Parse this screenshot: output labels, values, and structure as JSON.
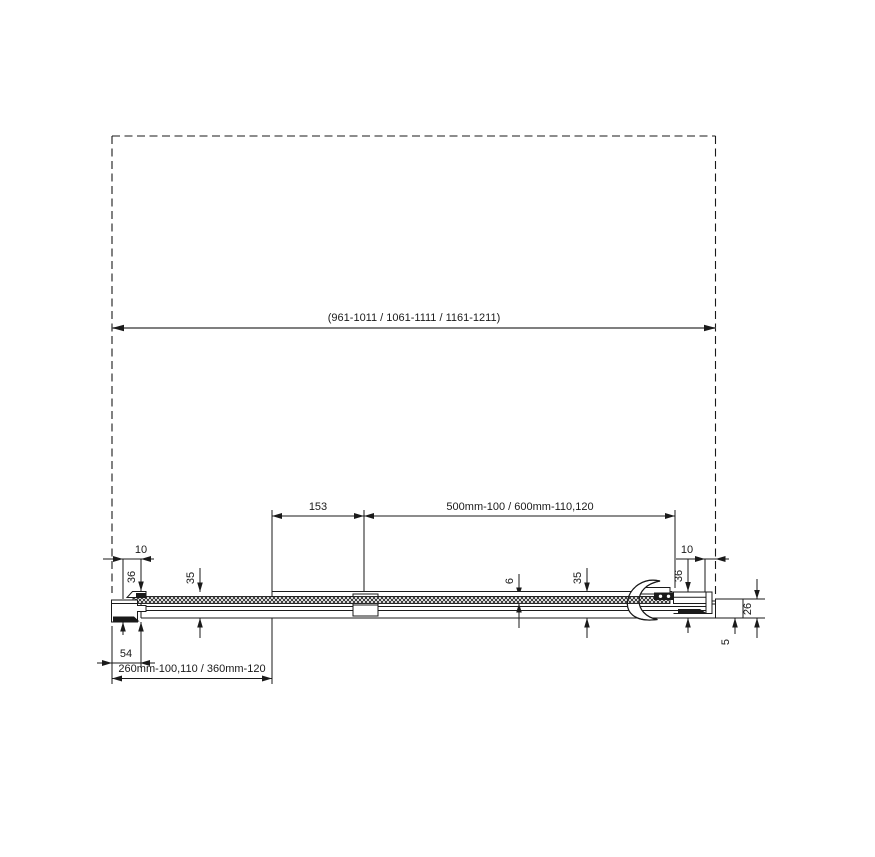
{
  "drawing": {
    "background_color": "#ffffff",
    "line_color": "#1a1a1a",
    "dimensions": {
      "overall_width_range": "(961-1011 / 1061-1111 / 1161-1211)",
      "top_rail_inset": "153",
      "door_leaf_width": "500mm-100 / 600mm-110,120",
      "wall_clearance_left": "10",
      "wall_profile_height_left": "36",
      "rail_depth_left": "35",
      "glass_thickness": "6",
      "rail_depth_right": "35",
      "wall_clearance_right": "10",
      "wall_profile_height_right": "36",
      "end_profile_depth": "26",
      "bottom_overlap": "5",
      "wall_profile_width": "54",
      "fixed_panel_width": "260mm-100,110 / 360mm-120"
    }
  }
}
